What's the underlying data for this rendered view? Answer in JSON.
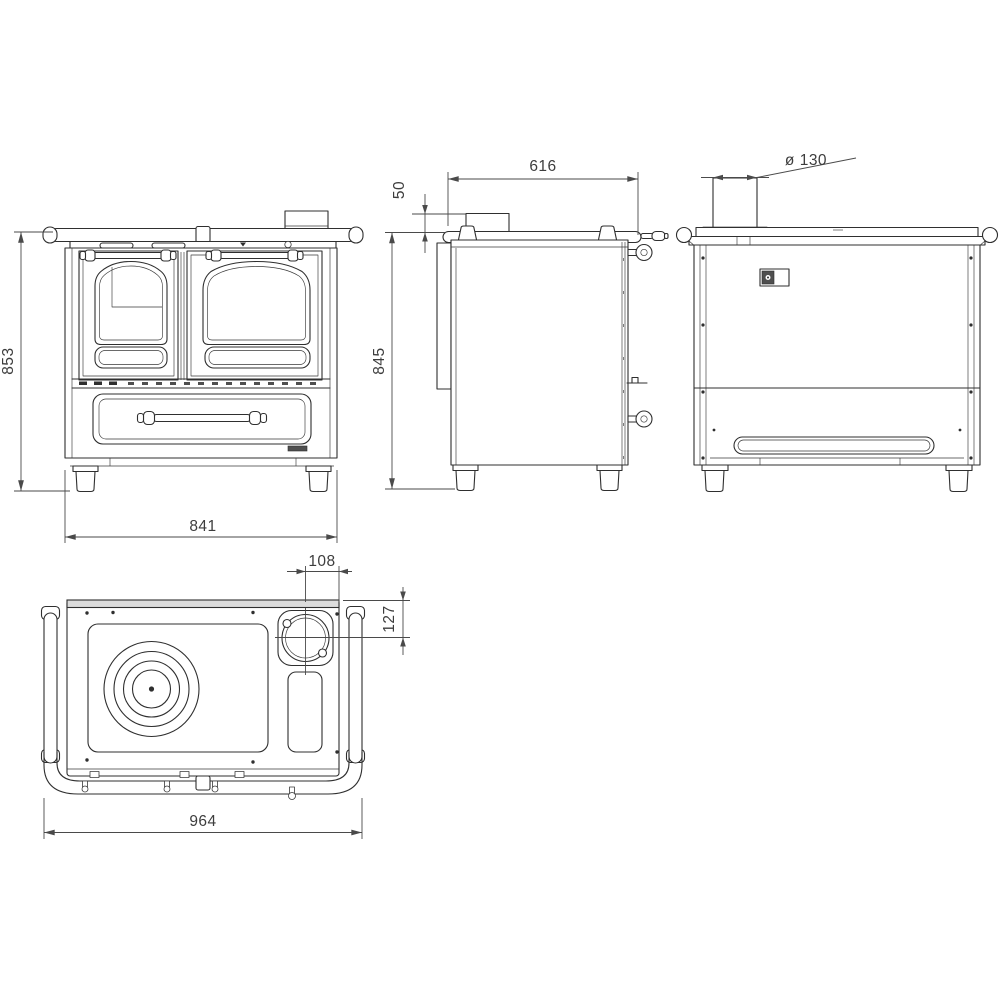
{
  "drawing": {
    "background": "#ffffff",
    "line_color": "#2f2f2f",
    "dim_color": "#4a4a4a",
    "text_color": "#3d3d3d"
  },
  "dimensions": {
    "front": {
      "height": "853",
      "width": "841"
    },
    "side": {
      "flue_collar_height": "50",
      "depth": "616",
      "height": "845"
    },
    "rear": {
      "flue_diameter": "ø 130"
    },
    "top": {
      "flue_center_to_side": "108",
      "flue_center_to_rear": "127",
      "overall_width": "964"
    }
  }
}
